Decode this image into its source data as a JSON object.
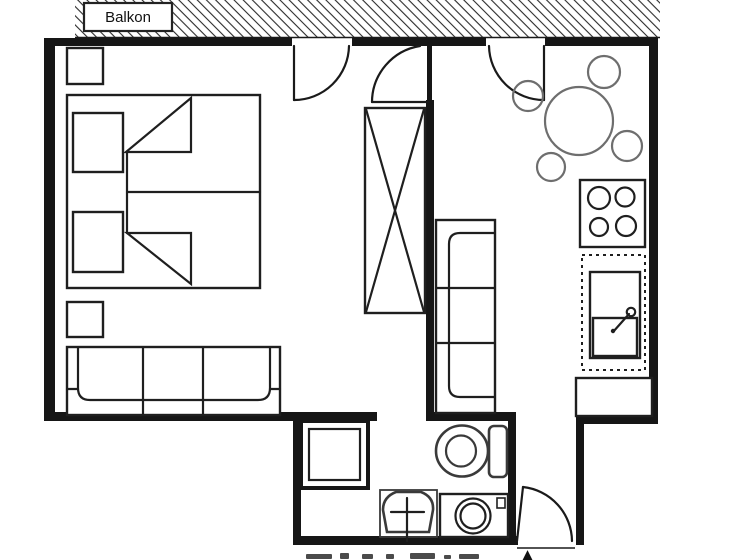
{
  "canvas": {
    "width": 739,
    "height": 560
  },
  "balcony": {
    "label": "Balkon"
  },
  "caption": {
    "north_arrow": "▲"
  },
  "colors": {
    "background": "#ffffff",
    "walls": "#161616",
    "furniture_dark": "#1f1f1f",
    "furniture_gray": "#6e6e6e",
    "bath_fixtures": "#3a3a3a",
    "hatch_lines": "#2a2a2a"
  }
}
